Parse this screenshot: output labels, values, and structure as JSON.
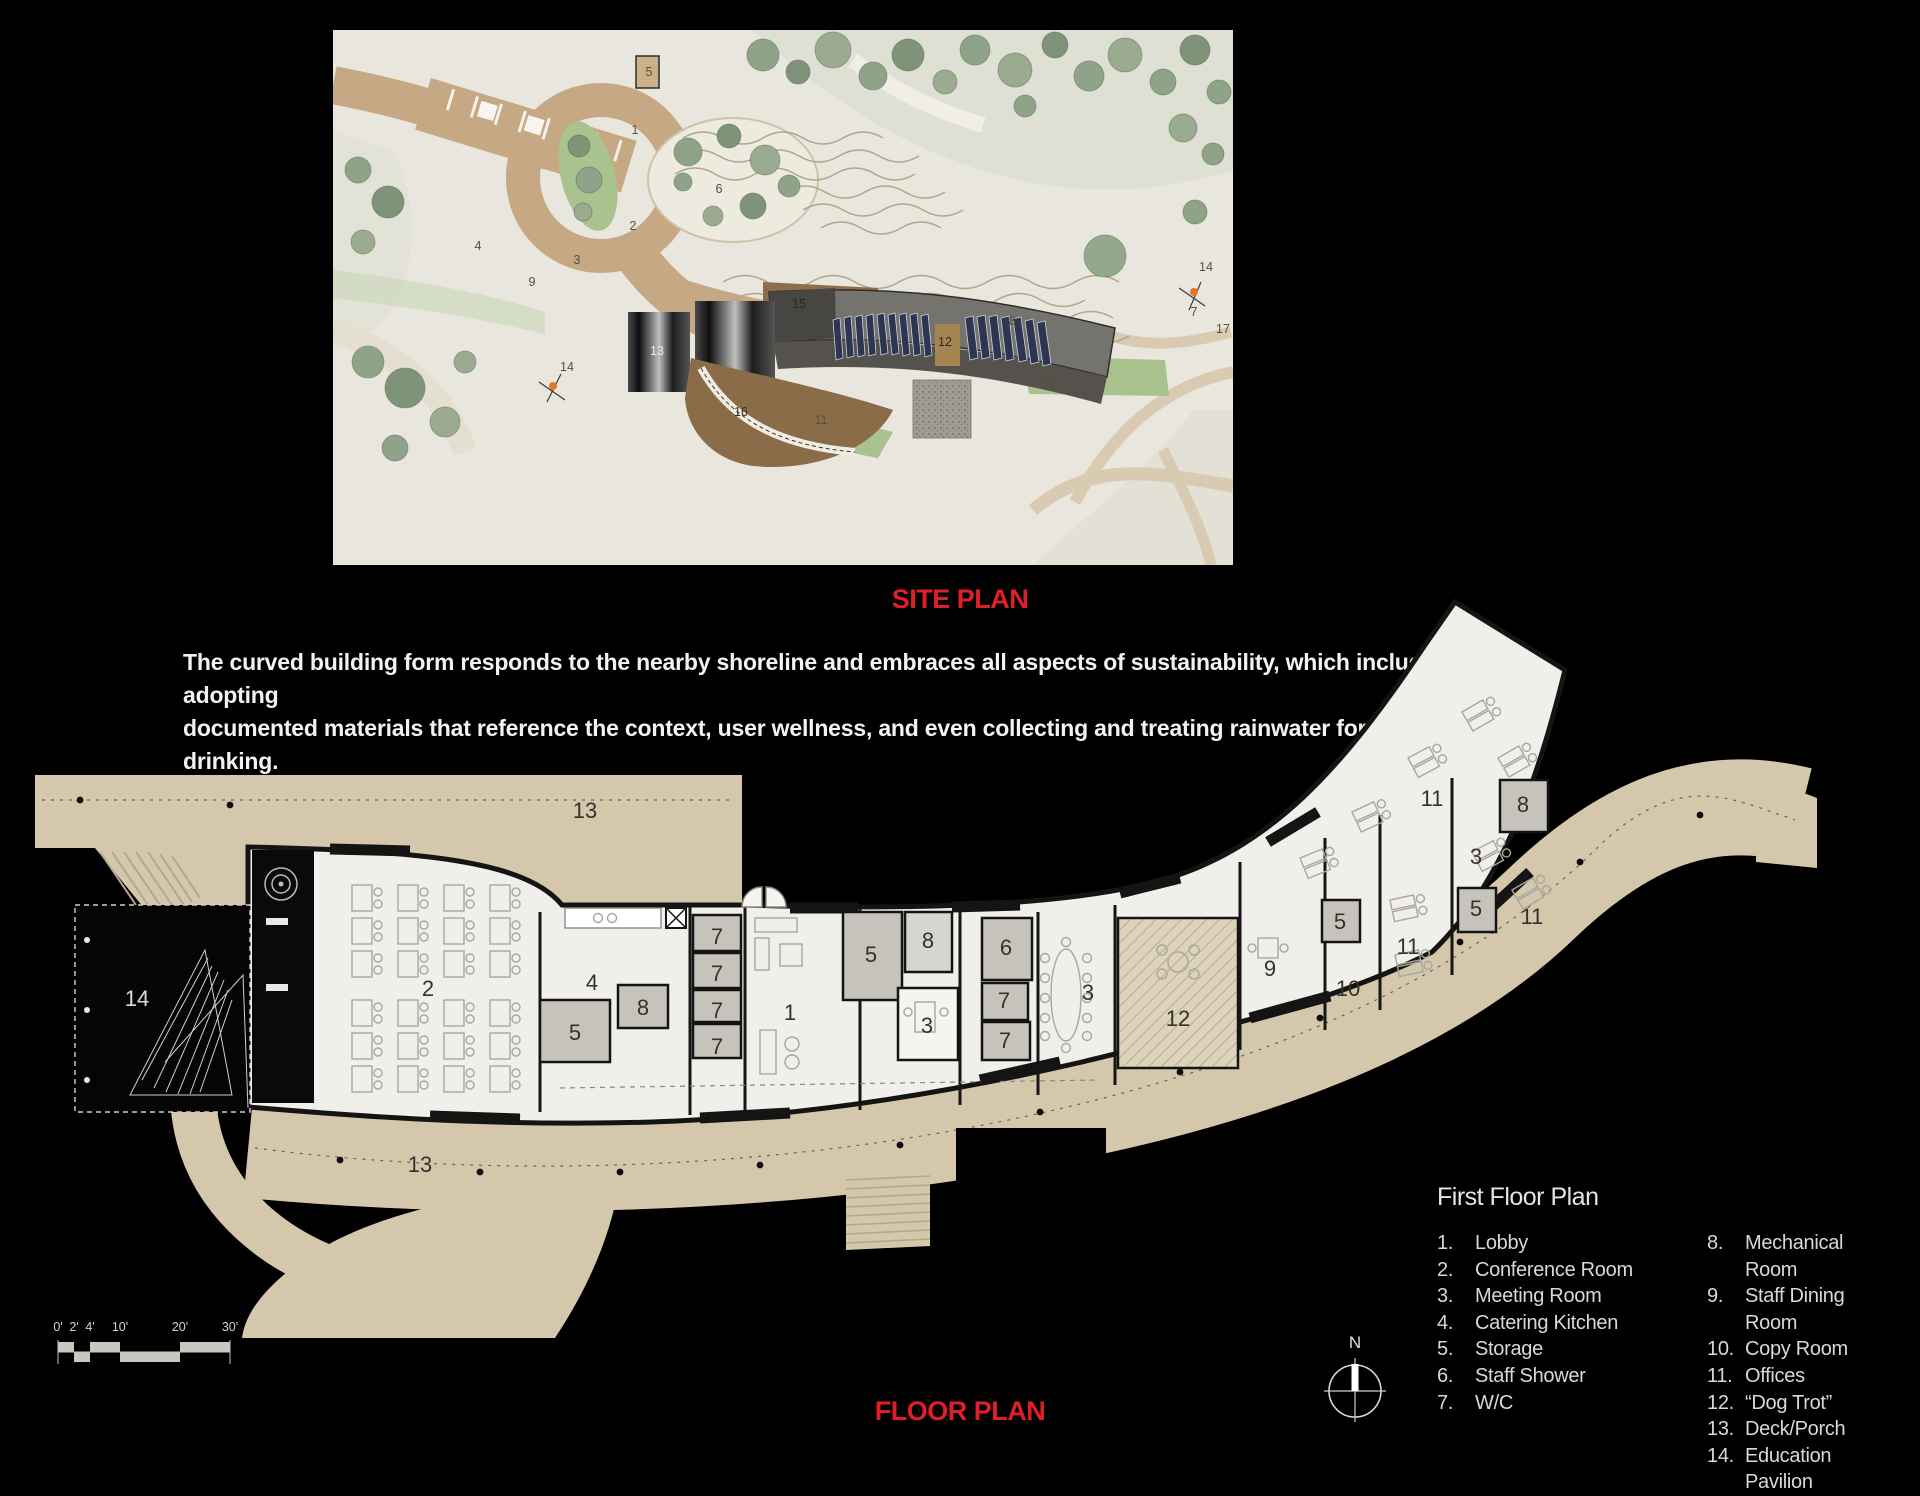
{
  "colors": {
    "page_bg": "#000000",
    "accent_red": "#df1f27",
    "paper": "#e9e6dd",
    "deck_tan": "#d5c7ab",
    "legend_text": "#d8d8d8",
    "solar_navy": "#2d3553"
  },
  "site_plan": {
    "title": "SITE PLAN",
    "labels": [
      {
        "t": "1",
        "x": 302,
        "y": 104
      },
      {
        "t": "2",
        "x": 300,
        "y": 200
      },
      {
        "t": "3",
        "x": 244,
        "y": 234
      },
      {
        "t": "4",
        "x": 145,
        "y": 220
      },
      {
        "t": "5",
        "x": 316,
        "y": 46
      },
      {
        "t": "6",
        "x": 386,
        "y": 163
      },
      {
        "t": "7",
        "x": 861,
        "y": 286
      },
      {
        "t": "8",
        "x": 679,
        "y": 295
      },
      {
        "t": "9",
        "x": 199,
        "y": 256
      },
      {
        "t": "10",
        "x": 714,
        "y": 354
      },
      {
        "t": "11",
        "x": 488,
        "y": 394
      },
      {
        "t": "12",
        "x": 612,
        "y": 316,
        "c": "#2e2920"
      },
      {
        "t": "13",
        "x": 324,
        "y": 325,
        "c": "#e8e8e8"
      },
      {
        "t": "14",
        "x": 234,
        "y": 341
      },
      {
        "t": "14",
        "x": 873,
        "y": 241
      },
      {
        "t": "15",
        "x": 466,
        "y": 278,
        "c": "#2e2920"
      },
      {
        "t": "16",
        "x": 408,
        "y": 386,
        "c": "#3a2f20"
      },
      {
        "t": "17",
        "x": 890,
        "y": 303
      }
    ]
  },
  "description": {
    "lines": [
      "The curved building form responds to the nearby shoreline and embraces all aspects of sustainability, which include adopting",
      "documented materials that reference the context, user wellness, and even collecting and treating rainwater for drinking."
    ]
  },
  "floor_plan": {
    "title": "FLOOR PLAN",
    "labels": [
      {
        "t": "13",
        "x": 585,
        "y": 818
      },
      {
        "t": "13",
        "x": 420,
        "y": 1172
      },
      {
        "t": "14",
        "x": 137,
        "y": 1006,
        "c": "#dcdcdc"
      },
      {
        "t": "2",
        "x": 428,
        "y": 996
      },
      {
        "t": "4",
        "x": 592,
        "y": 990
      },
      {
        "t": "5",
        "x": 575,
        "y": 1040
      },
      {
        "t": "8",
        "x": 643,
        "y": 1015
      },
      {
        "t": "7",
        "x": 717,
        "y": 944
      },
      {
        "t": "7",
        "x": 717,
        "y": 981
      },
      {
        "t": "7",
        "x": 717,
        "y": 1018
      },
      {
        "t": "7",
        "x": 717,
        "y": 1054
      },
      {
        "t": "1",
        "x": 790,
        "y": 1020
      },
      {
        "t": "5",
        "x": 871,
        "y": 962
      },
      {
        "t": "8",
        "x": 928,
        "y": 948
      },
      {
        "t": "3",
        "x": 927,
        "y": 1033
      },
      {
        "t": "6",
        "x": 1006,
        "y": 955
      },
      {
        "t": "7",
        "x": 1004,
        "y": 1008
      },
      {
        "t": "7",
        "x": 1005,
        "y": 1048
      },
      {
        "t": "3",
        "x": 1088,
        "y": 1000
      },
      {
        "t": "12",
        "x": 1178,
        "y": 1026
      },
      {
        "t": "9",
        "x": 1270,
        "y": 976
      },
      {
        "t": "5",
        "x": 1340,
        "y": 929
      },
      {
        "t": "10",
        "x": 1348,
        "y": 996
      },
      {
        "t": "11",
        "x": 1408,
        "y": 954
      },
      {
        "t": "5",
        "x": 1476,
        "y": 916
      },
      {
        "t": "3",
        "x": 1476,
        "y": 864
      },
      {
        "t": "8",
        "x": 1523,
        "y": 812
      },
      {
        "t": "11",
        "x": 1532,
        "y": 924
      },
      {
        "t": "11",
        "x": 1432,
        "y": 806
      }
    ]
  },
  "legend": {
    "heading": "First Floor Plan",
    "columns": [
      [
        {
          "n": "1.",
          "label": "Lobby"
        },
        {
          "n": "2.",
          "label": "Conference Room"
        },
        {
          "n": "3.",
          "label": "Meeting Room"
        },
        {
          "n": "4.",
          "label": "Catering Kitchen"
        },
        {
          "n": "5.",
          "label": "Storage"
        },
        {
          "n": "6.",
          "label": "Staff Shower"
        },
        {
          "n": "7.",
          "label": "W/C"
        }
      ],
      [
        {
          "n": "8.",
          "label": "Mechanical Room"
        },
        {
          "n": "9.",
          "label": "Staff Dining Room"
        },
        {
          "n": "10.",
          "label": "Copy Room"
        },
        {
          "n": "11.",
          "label": "Offices"
        },
        {
          "n": "12.",
          "label": "“Dog Trot”"
        },
        {
          "n": "13.",
          "label": "Deck/Porch"
        },
        {
          "n": "14.",
          "label": "Education Pavilion"
        }
      ]
    ]
  },
  "compass": {
    "label": "N"
  },
  "scale_bar": {
    "ticks": [
      "0'",
      "2'",
      "4'",
      "10'",
      "20'",
      "30'"
    ]
  }
}
